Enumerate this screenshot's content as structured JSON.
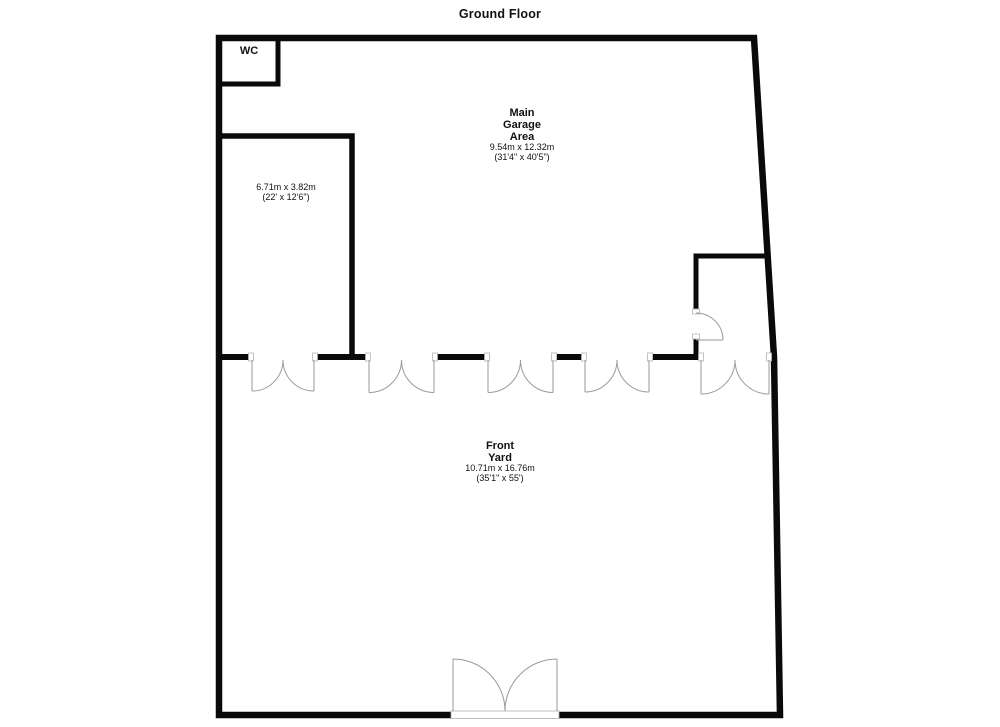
{
  "title": "Ground Floor",
  "rooms": {
    "wc": {
      "name": "WC"
    },
    "store_room": {
      "dims_metric": "6.71m x 3.82m",
      "dims_imperial": "(22' x 12'6\")"
    },
    "garage": {
      "name_lines": [
        "Main",
        "Garage",
        "Area"
      ],
      "dims_metric": "9.54m x 12.32m",
      "dims_imperial": "(31'4\" x 40'5\")"
    },
    "front_yard": {
      "name_lines": [
        "Front",
        "Yard"
      ],
      "dims_metric": "10.71m x 16.76m",
      "dims_imperial": "(35'1\" x 55')"
    }
  },
  "colors": {
    "wall": "#0a0a0a",
    "door": "#9a9a9a",
    "jamb_border": "#b5b5b5",
    "background": "#ffffff"
  }
}
